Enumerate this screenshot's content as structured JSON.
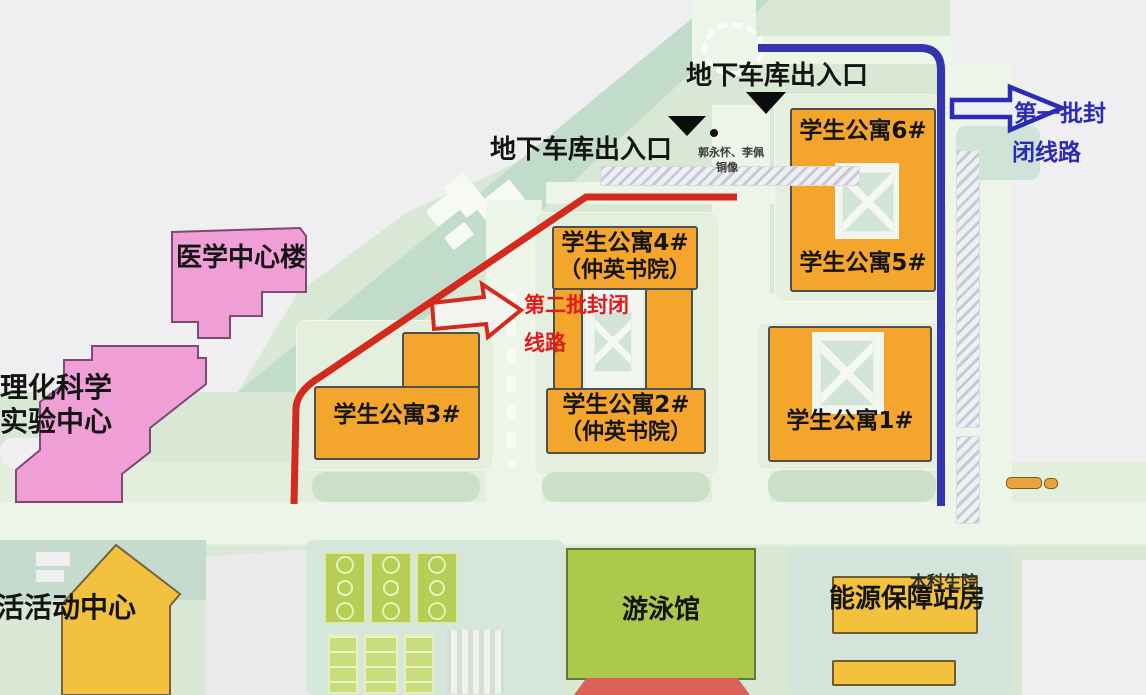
{
  "map": {
    "annotations": {
      "garage_top": "地下车库出入口",
      "garage_left": "地下车库出入口",
      "statue_name": "郭永怀、李佩",
      "statue_type": "铜像"
    },
    "routes": {
      "first_closed": {
        "line1": "第一批封",
        "line2": "闭线路",
        "color": "#3434ae"
      },
      "second_closed": {
        "line1": "第二批封闭",
        "line2": "线路",
        "color": "#d42a1e"
      }
    },
    "buildings": {
      "apt6": "学生公寓6#",
      "apt5": "学生公寓5#",
      "apt4": "学生公寓4#",
      "apt4_college": "（仲英书院）",
      "apt3": "学生公寓3#",
      "apt2": "学生公寓2#",
      "apt2_college": "（仲英书院）",
      "apt1": "学生公寓1#",
      "medical_center": "医学中心楼",
      "science_center_line1": "理化科学",
      "science_center_line2": "实验中心",
      "activity_center": "活活动中心",
      "swimming_pool": "游泳馆",
      "energy_station": "能源保障站房",
      "undergraduate_school": "本科生院"
    },
    "colors": {
      "campus_green": "#d9e8d4",
      "apartment_orange": "#f4a62c",
      "building_pink": "#ef9fd6",
      "facility_yellow": "#f2c23e",
      "pool_green": "#abc94d",
      "route_red": "#d42a1e",
      "route_blue": "#3434ae"
    }
  }
}
